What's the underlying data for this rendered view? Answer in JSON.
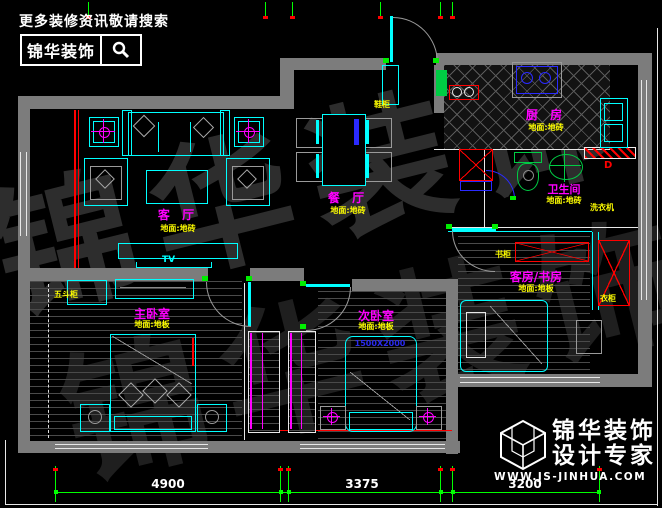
{
  "search_banner": {
    "tagline": "更多装修资讯敬请搜索",
    "brand": "锦华装饰"
  },
  "brand_logo": {
    "name": "锦华装饰",
    "slogan": "设计专家",
    "website": "WWW.JS-JINHUA.COM"
  },
  "watermark": {
    "text": "锦华装饰"
  },
  "rooms": {
    "living": {
      "name": "客 厅",
      "finish": "地面:地砖"
    },
    "dining": {
      "name": "餐 厅",
      "finish": "地面:地砖"
    },
    "kitchen": {
      "name": "厨 房",
      "finish": "地面:地砖"
    },
    "bath": {
      "name": "卫生间",
      "finish": "地面:地砖"
    },
    "study": {
      "name": "客房/书房",
      "finish": "地面:地板"
    },
    "master": {
      "name": "主卧室",
      "finish": "地面:地板"
    },
    "second": {
      "name": "次卧室",
      "finish": "地面:地板"
    }
  },
  "annotations": {
    "shoe_cabinet": "鞋柜",
    "bookcase": "书柜",
    "wardrobe": "衣柜",
    "chest": "五斗柜",
    "washer": "洗衣机",
    "tv": "TV",
    "bed_size": "1500X2000",
    "drain": "D"
  },
  "dimensions": {
    "d1": "4900",
    "d2": "3375",
    "d3": "3200"
  },
  "colors": {
    "furniture": "#00ffff",
    "room_label": "#ff00ff",
    "finish_label": "#ffff00",
    "dimension": "#00ff00",
    "wall": "#7c7c7c",
    "accent_red": "#ff0000",
    "accent_blue": "#2a2aff"
  }
}
